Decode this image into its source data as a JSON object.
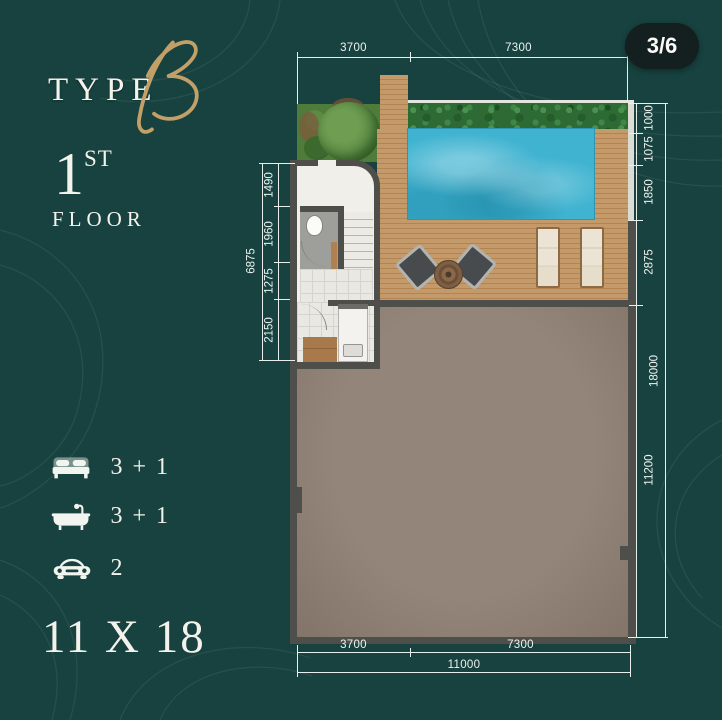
{
  "page": {
    "badge": "3/6"
  },
  "logo": {
    "type_label": "TYPE",
    "type_letter": "B",
    "floor_number": "1",
    "floor_ordinal": "ST",
    "floor_word": "FLOOR"
  },
  "amenities": {
    "items": [
      {
        "icon": "bed-icon",
        "value": "3 + 1"
      },
      {
        "icon": "bathtub-icon",
        "value": "3 + 1"
      },
      {
        "icon": "car-icon",
        "value": "2"
      }
    ]
  },
  "plot_size": "11 X 18",
  "dimensions": {
    "top": {
      "left": "3700",
      "right": "7300"
    },
    "bottom": {
      "left": "3700",
      "right": "7300",
      "total": "11000"
    },
    "right": {
      "segments": [
        "1000",
        "1075",
        "1850",
        "2875",
        "11200"
      ],
      "total": "18000"
    },
    "left": {
      "segments": [
        "1490",
        "1960",
        "1275",
        "2150"
      ],
      "total": "6875"
    }
  },
  "colors": {
    "background": "#17423f",
    "accent_gold": "#c2a068",
    "pool": "#3fb3d0",
    "deck": "#c59a6a",
    "hedge": "#2d6a34",
    "floor_area": "#8c7d70",
    "wall": "#4e4f4b",
    "badge_bg": "#141f1f",
    "text": "#f2f4ef"
  }
}
